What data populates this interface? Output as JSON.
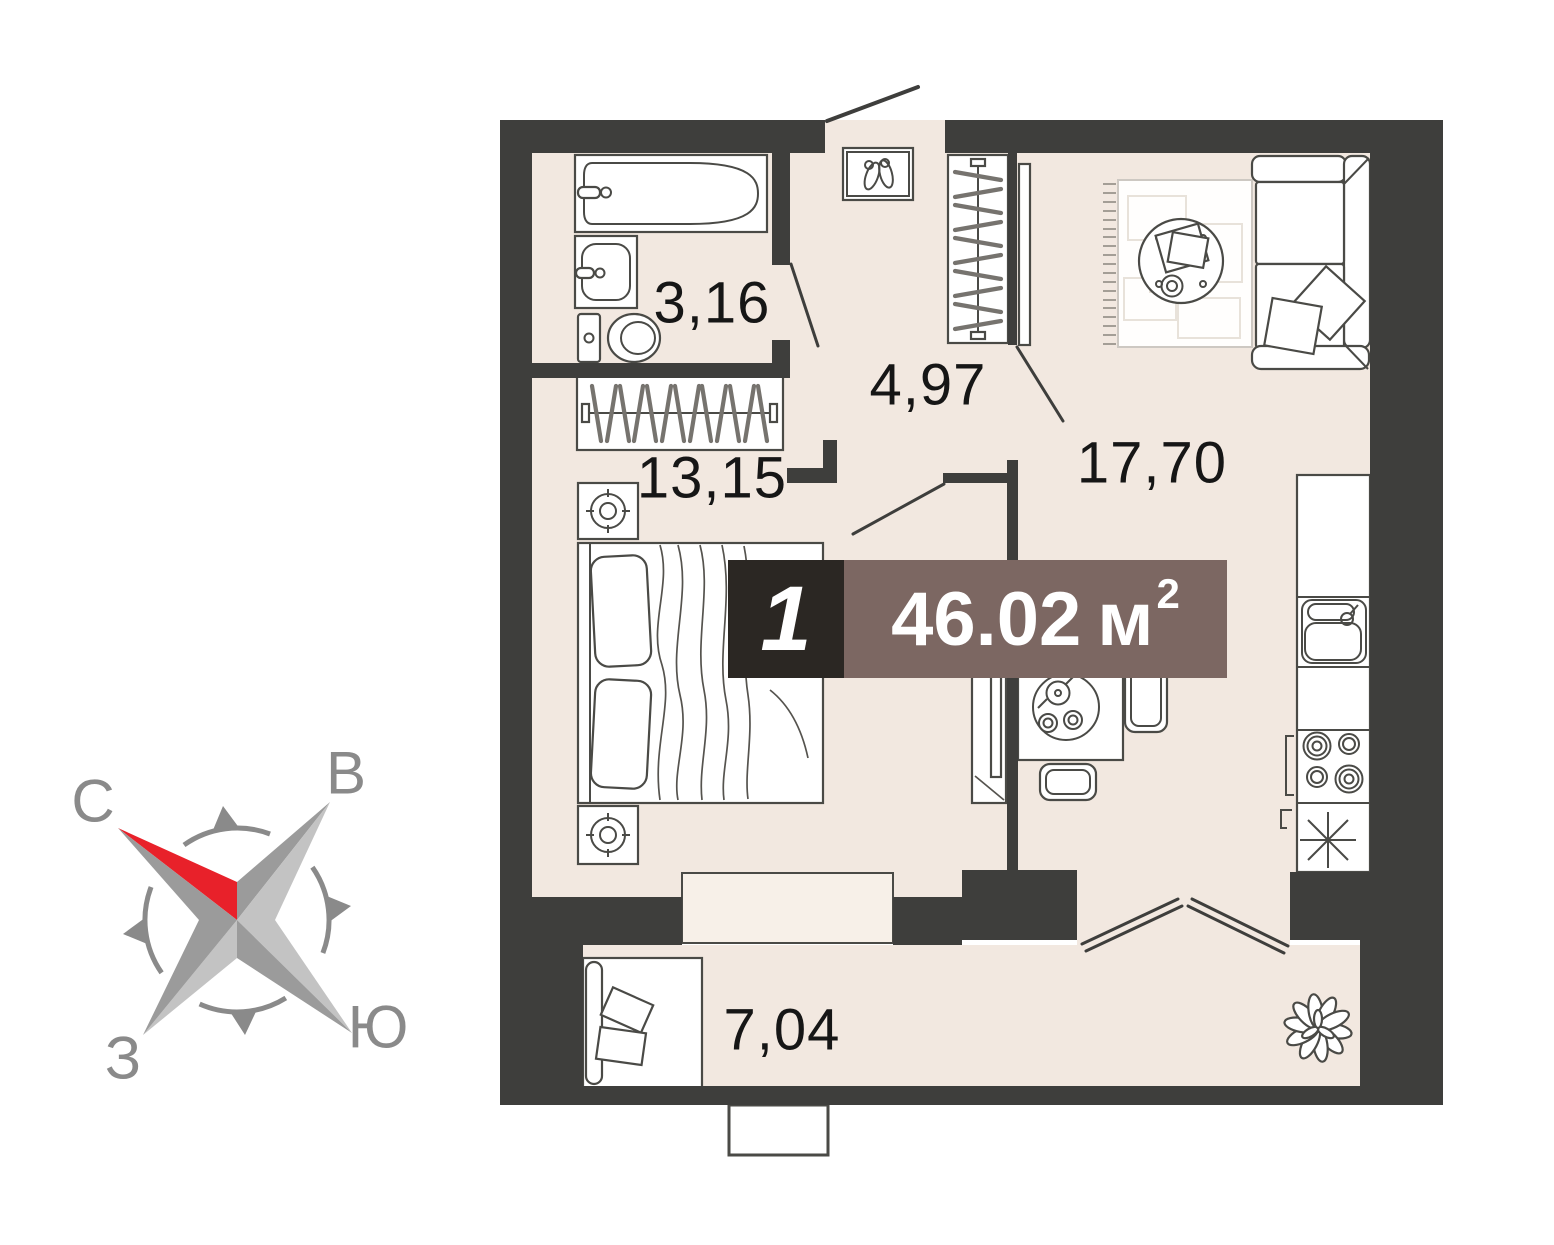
{
  "badge": {
    "room_count": "1",
    "area_value": "46.02",
    "area_unit": "м",
    "area_superscript": "2"
  },
  "room_labels": {
    "bathroom": "3,16",
    "hallway": "4,97",
    "living_room": "17,70",
    "bedroom": "13,15",
    "balcony": "7,04"
  },
  "compass": {
    "north": "С",
    "east": "В",
    "south": "Ю",
    "west": "З"
  },
  "theme": {
    "wall_color": "#3E3E3C",
    "floor_color": "#F2E8E0",
    "floor_light_color": "#F7F0E8",
    "outline_color": "#4A4A46",
    "badge_dark_color": "#2B2723",
    "badge_brown_color": "#7C6762",
    "accent_red_color": "#E8212A",
    "compass_gray_color": "#8A8A8A",
    "compass_light_color": "#C3C3C3",
    "compass_mid_color": "#9B9B9B",
    "label_color": "#161616"
  }
}
